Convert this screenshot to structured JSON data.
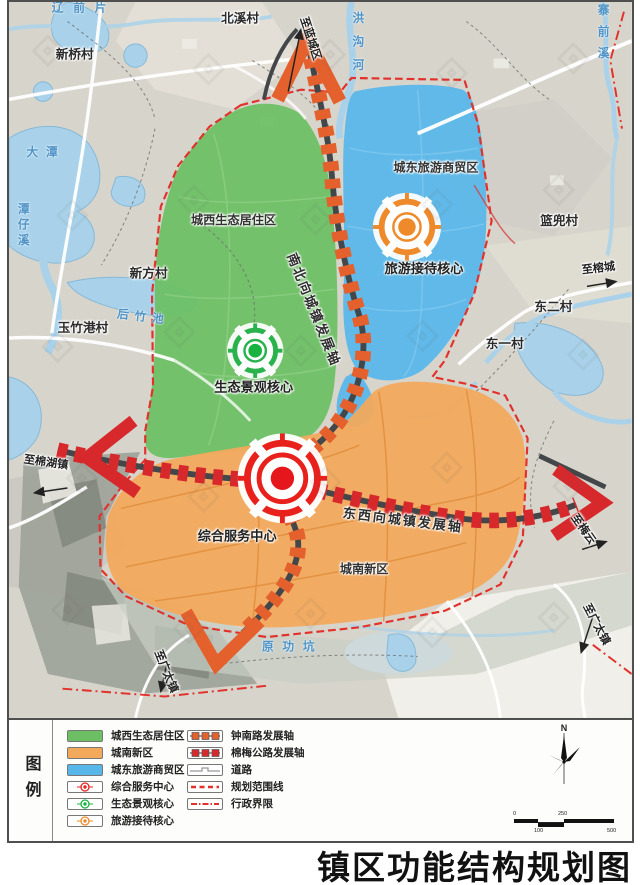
{
  "title": "镇区功能结构规划图",
  "map": {
    "zone_labels": {
      "west": {
        "label": "城西生态居住区",
        "color": "#6cc063"
      },
      "east": {
        "label": "城东旅游商贸区",
        "color": "#57b7e9"
      },
      "south": {
        "label": "城南新区",
        "color": "#f2a95c"
      }
    },
    "core_labels": {
      "eco": {
        "label": "生态景观核心",
        "color": "#17b33e"
      },
      "tourism": {
        "label": "旅游接待核心",
        "color": "#ee8a2a"
      },
      "service": {
        "label": "综合服务中心",
        "color": "#e8211d"
      }
    },
    "axis_labels": {
      "ns": {
        "label": "南北向城镇发展轴",
        "color": "#e4602c"
      },
      "ew": {
        "label": "东西向城镇发展轴",
        "color": "#d7282c"
      }
    },
    "villages": {
      "beixi": "北溪村",
      "xinqiao": "新桥村",
      "xinfang": "新方村",
      "yuzhugang": "玉竹港村",
      "landou": "篮兜村",
      "donger": "东二村",
      "dongyi": "东一村"
    },
    "waters": {
      "liaoqianpian": "辽前片",
      "datan": "大潭",
      "tanzixi": "潭仔溪",
      "houzhuchi": "后竹池",
      "honggouhe": "洪沟河",
      "zhaiqianxi": "寨前溪",
      "yuangongkeng": "原功坑"
    },
    "directions": {
      "north": "至蓝城区",
      "east": "至榕城",
      "west": "至棉湖镇",
      "ew_east": "至梅云",
      "south_left": "至广太镇",
      "south_right": "至广太镇"
    }
  },
  "legend": {
    "heading": "图例",
    "zones": [
      {
        "label": "城西生态居住区",
        "color": "#6cc063"
      },
      {
        "label": "城南新区",
        "color": "#f2a95c"
      },
      {
        "label": "城东旅游商贸区",
        "color": "#57b7e9"
      }
    ],
    "cores": [
      {
        "label": "综合服务中心",
        "color": "#e8211d"
      },
      {
        "label": "生态景观核心",
        "color": "#17b33e"
      },
      {
        "label": "旅游接待核心",
        "color": "#ee8a2a"
      }
    ],
    "lines": [
      {
        "label": "钟南路发展轴",
        "color": "#e4602c"
      },
      {
        "label": "棉梅公路发展轴",
        "color": "#d7282c"
      },
      {
        "label": "道路",
        "color": "#999999"
      },
      {
        "label": "规划范围线",
        "color": "#e2302a"
      },
      {
        "label": "行政界限",
        "color": "#e2302a"
      }
    ],
    "compass": "N",
    "scale_ticks": [
      "0",
      "100",
      "250",
      "500"
    ]
  }
}
